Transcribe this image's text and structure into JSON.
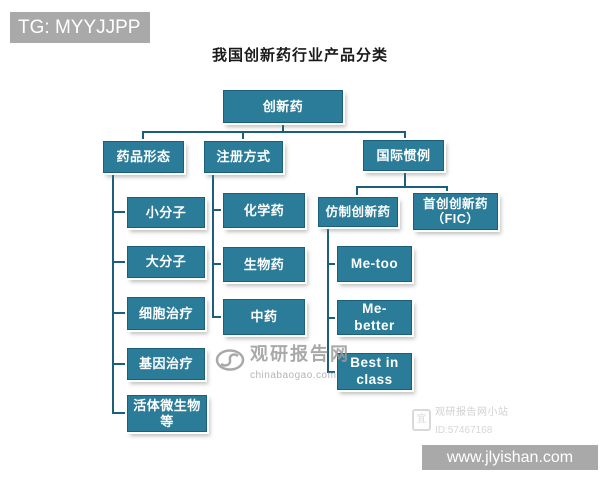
{
  "title": "我国创新药行业产品分类",
  "overlays": {
    "tg_banner": "TG: MYYJJPP",
    "site_banner": "www.jlyishan.com"
  },
  "tree": {
    "root": "创新药",
    "branches": [
      {
        "label": "药品形态",
        "children": [
          "小分子",
          "大分子",
          "细胞治疗",
          "基因治疗",
          "活体微生物等"
        ]
      },
      {
        "label": "注册方式",
        "children": [
          "化学药",
          "生物药",
          "中药"
        ]
      },
      {
        "label": "国际惯例",
        "children": [
          {
            "label": "仿制创新药",
            "children": [
              "Me-too",
              "Me-better",
              "Best in class"
            ]
          },
          {
            "label": "首创创新药",
            "label2": "（FIC）"
          }
        ]
      }
    ]
  },
  "watermarks": {
    "center": {
      "brand": "观研报告网",
      "domain": "chinabaogao.com"
    },
    "corner": {
      "name": "观研报告网小站",
      "id": "ID:57467168"
    }
  },
  "colors": {
    "node_fill": "#2b7c99",
    "node_border": "#1b5f7b",
    "connector": "#1b5f7b",
    "banner_gray": "#a9a9a9",
    "watermark_gray": "#9b9b9b",
    "title_text": "#1a1a1a",
    "node_text": "#ffffff"
  }
}
